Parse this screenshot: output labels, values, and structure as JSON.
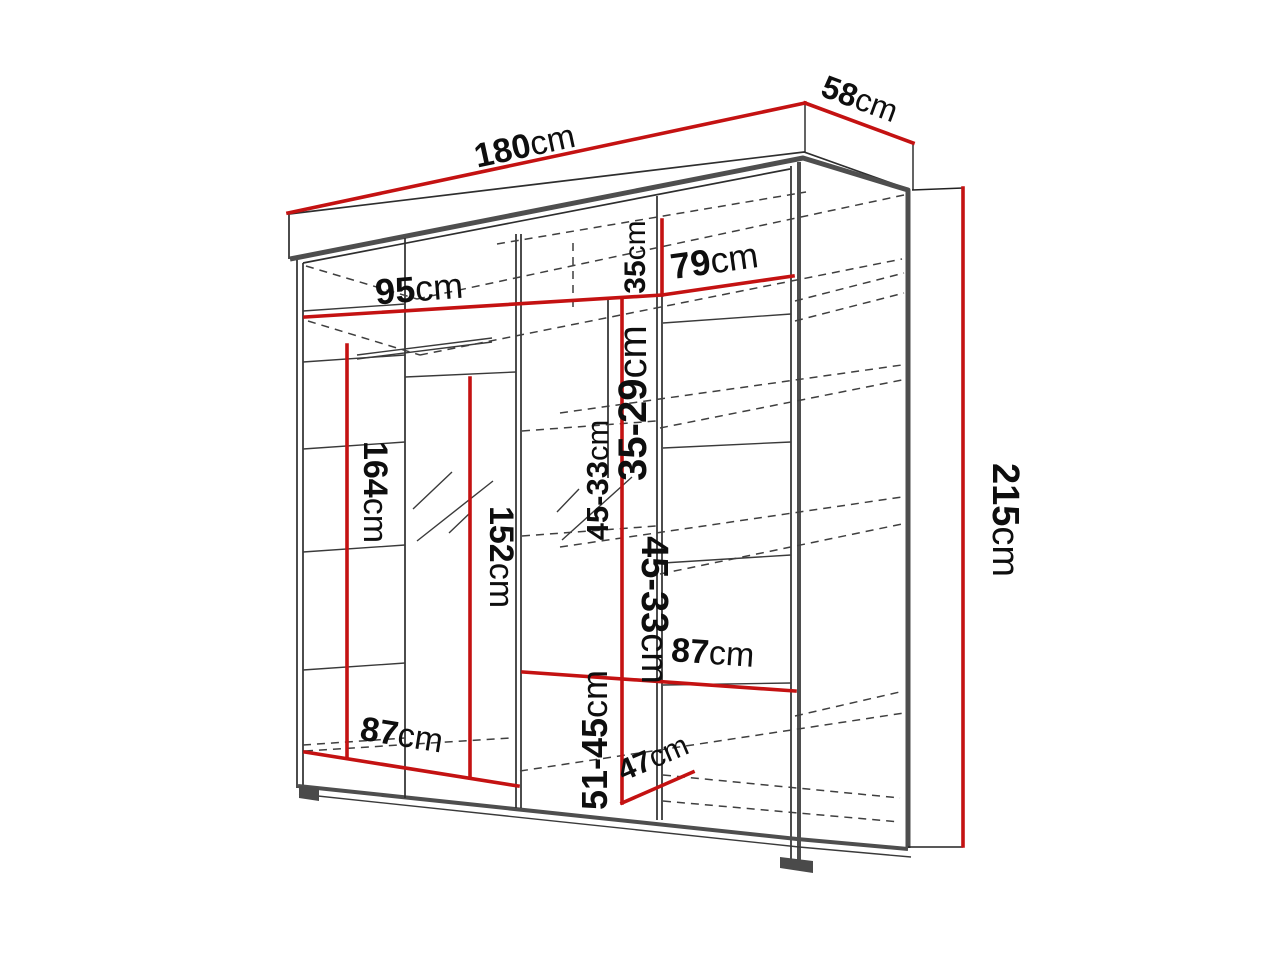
{
  "diagram": {
    "title": "Wardrobe dimension drawing",
    "unit": "cm",
    "colors": {
      "dimension_line": "#c41212",
      "outline": "#4e4e4e",
      "interior_line": "#2e2e2e",
      "text": "#0e0e0e",
      "background": "#ffffff"
    },
    "dimensions": {
      "total_width": {
        "num": "180",
        "unit": "cm"
      },
      "total_depth": {
        "num": "58",
        "unit": "cm"
      },
      "total_height": {
        "num": "215",
        "unit": "cm"
      },
      "interior_width_left": {
        "num": "95",
        "unit": "cm"
      },
      "interior_width_right": {
        "num": "79",
        "unit": "cm"
      },
      "top_section_height": {
        "num": "35",
        "unit": "cm"
      },
      "upper_shelf_spacing": {
        "num": "35-29",
        "unit": "cm"
      },
      "middle_shelf_spacing_a": {
        "num": "45-33",
        "unit": "cm"
      },
      "middle_shelf_spacing_b": {
        "num": "45-33",
        "unit": "cm"
      },
      "left_section_height": {
        "num": "164",
        "unit": "cm"
      },
      "mirror_door_height": {
        "num": "152",
        "unit": "cm"
      },
      "lower_shelf_width": {
        "num": "87",
        "unit": "cm"
      },
      "right_shelf_width": {
        "num": "87",
        "unit": "cm"
      },
      "bottom_section_height": {
        "num": "51-45",
        "unit": "cm"
      },
      "bottom_shelf_depth": {
        "num": "47",
        "unit": "cm"
      }
    }
  }
}
